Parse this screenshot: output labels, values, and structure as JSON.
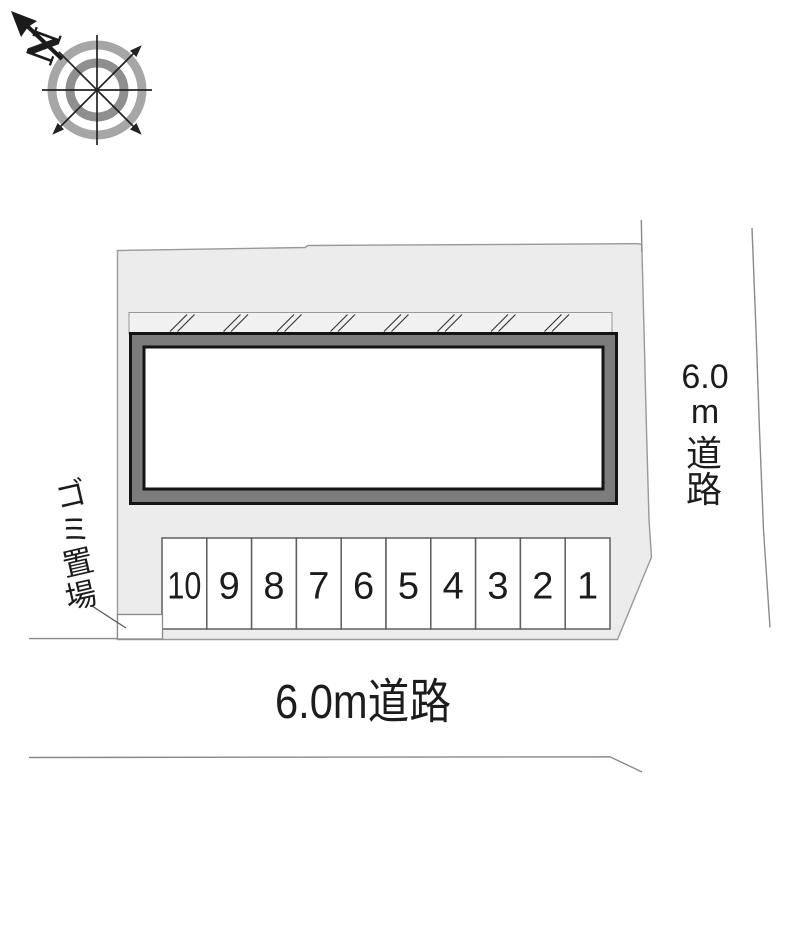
{
  "compass": {
    "north_label": "N"
  },
  "parking": {
    "numbers": [
      "10",
      "9",
      "8",
      "7",
      "6",
      "5",
      "4",
      "3",
      "2",
      "1"
    ]
  },
  "garbage_area": {
    "label": "ゴミ置場",
    "chars": [
      "ゴ",
      "ミ",
      "置",
      "場"
    ]
  },
  "roads": {
    "right": {
      "label": "6.0m道路",
      "lines": [
        "6.0",
        "m",
        "道",
        "路"
      ]
    },
    "bottom": {
      "label": "6.0m道路"
    }
  },
  "colors": {
    "lot_fill": "#ececec",
    "lot_stroke": "#999999",
    "building_band": "#7c7c7c",
    "building_outline": "#141414",
    "parking_stroke": "#5f5f5f",
    "hatch_line": "#3a3a3a",
    "road_line": "#8a8a8a",
    "text": "#1c1c1c",
    "compass_ring_outer": "#a6a6a6",
    "compass_ring_inner": "#8f8f8f"
  }
}
